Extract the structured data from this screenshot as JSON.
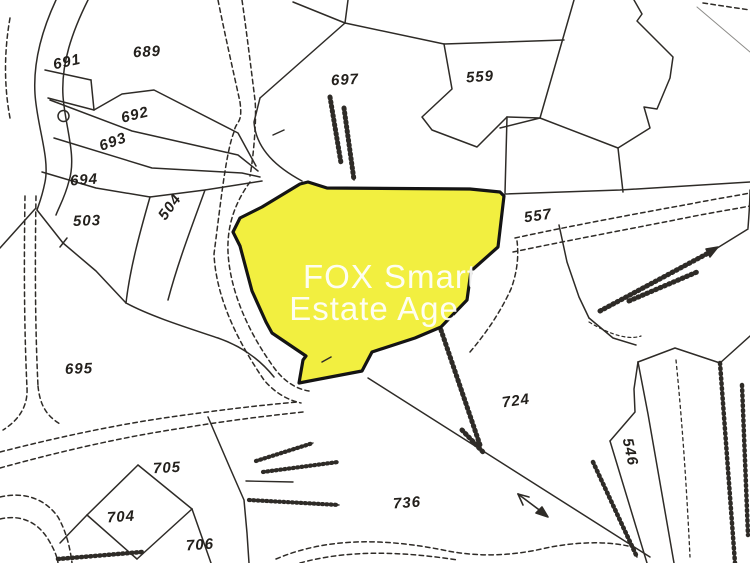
{
  "map": {
    "title": "Cadastral plan with highlighted plot",
    "background": "#ffffff",
    "line_color": "#2e2b27",
    "highlight": {
      "fill": "#F2EF40",
      "stroke": "#141414"
    },
    "watermark": {
      "line1": "FOX Smart",
      "line2": "Estate Age",
      "color": "#ffffff"
    },
    "parcels": [
      {
        "id": "691",
        "x": 67,
        "y": 62,
        "rot": -12
      },
      {
        "id": "689",
        "x": 147,
        "y": 52,
        "rot": -3
      },
      {
        "id": "692",
        "x": 135,
        "y": 115,
        "rot": -14
      },
      {
        "id": "693",
        "x": 113,
        "y": 142,
        "rot": -20
      },
      {
        "id": "694",
        "x": 84,
        "y": 180,
        "rot": -4
      },
      {
        "id": "503",
        "x": 87,
        "y": 221,
        "rot": -2
      },
      {
        "id": "504",
        "x": 170,
        "y": 207,
        "rot": -54
      },
      {
        "id": "697",
        "x": 345,
        "y": 80,
        "rot": -3
      },
      {
        "id": "559",
        "x": 480,
        "y": 77,
        "rot": -4
      },
      {
        "id": "557",
        "x": 538,
        "y": 216,
        "rot": -8
      },
      {
        "id": "695",
        "x": 79,
        "y": 369,
        "rot": -2
      },
      {
        "id": "724",
        "x": 516,
        "y": 401,
        "rot": -8
      },
      {
        "id": "546",
        "x": 630,
        "y": 452,
        "rot": 78
      },
      {
        "id": "736",
        "x": 407,
        "y": 503,
        "rot": -4
      },
      {
        "id": "705",
        "x": 167,
        "y": 468,
        "rot": -3
      },
      {
        "id": "704",
        "x": 121,
        "y": 517,
        "rot": -4
      },
      {
        "id": "706",
        "x": 200,
        "y": 545,
        "rot": -4
      }
    ],
    "symbols": [
      {
        "name": "well-icon"
      },
      {
        "name": "flow-arrow-icon"
      },
      {
        "name": "direction-arrow-icon"
      }
    ]
  }
}
